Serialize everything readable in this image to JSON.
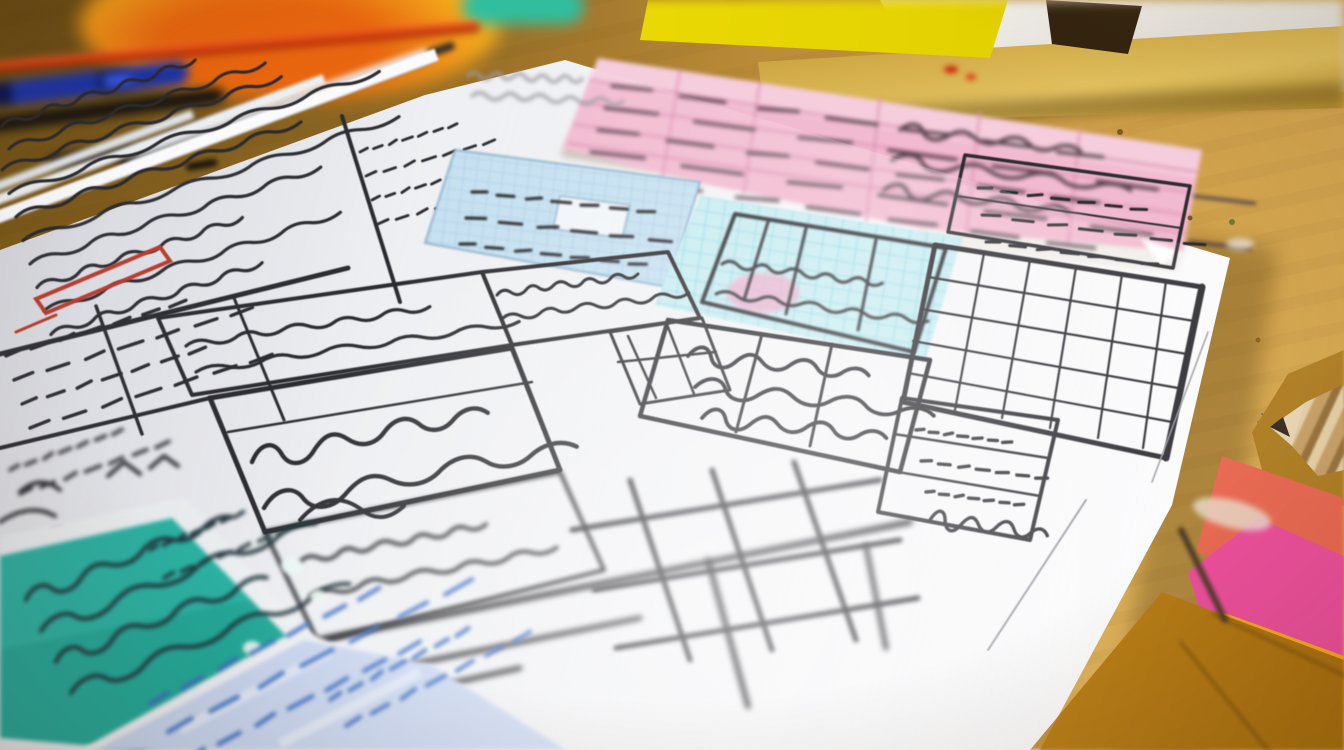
{
  "scene": {
    "title": "Hand-drawn wireframe sketches on a desk",
    "description": "Close-up photograph, shallow depth of field: a large white sheet covered with hand-drawn wireframe tables and grid panels lies on a warm golden wooden desk. Sections of the sketch are highlighted in pink, light blue, cyan, teal and lavender; one row is outlined in red ink. All handwriting is illegible scribble. Around the sheet: out-of-focus pens (red, blue, black, silver) at the top left, a bright yellow sticky note, a green marker cap, a wooden ruler or book edge and a white paper at the top right, a large pink ruled handwritten note across the top, and orange, magenta and salmon sticky notes with folded amber paper at the bottom right. A sharpened pencil and a small pencil leaf doodle appear at the right edge.",
    "handwriting_legible": false
  },
  "palette": {
    "desk": "#a87b2c",
    "desk_dark": "#8a651f",
    "desk_light": "#d9ab55",
    "paper": "#f5f5f7",
    "ink": "#2b2b30",
    "ink_soft": "#9a9aa2",
    "red_annotation": "#c23b2a",
    "pink_panel": "#f2bad0",
    "pink_note_row": "#dd93b4",
    "note_ink": "#52404a",
    "blue_panel": "#c6e1f1",
    "blue_grid": "#9cbedb",
    "cyan_panel": "#c8edf2",
    "cyan_grid": "#84d2e0",
    "pink_blob": "#f2a8c8",
    "teal_panel": "#29b2a2",
    "teal_ink": "#1c3238",
    "lavender_panel": "#c9d6f0",
    "lavender_ink": "#3a6cc0",
    "sticky_yellow": "#f6e607",
    "sticky_orange": "#f8a81e",
    "sticky_magenta": "#ec4f9b",
    "sticky_salmon": "#ef7f68",
    "paper_amber": "#cf9426",
    "pen_red": "#dd3a0e",
    "pen_blue": "#1c33a6",
    "pen_silver": "#d7d9dd",
    "pen_black": "#141210",
    "green_cap": "#2fbf9f",
    "ruler_wood": "#c9a03c",
    "pencil_wood": "#caa36a",
    "graphite": "#3a3226"
  },
  "objects": [
    {
      "name": "desk-surface",
      "description": "Warm golden-brown wooden desk surface"
    },
    {
      "name": "sketch-sheet",
      "description": "Large white sheet with hand-drawn wireframe tables, grids and illegible scribbled handwriting"
    },
    {
      "name": "sheet-stack-edges",
      "description": "Edges of extra white sheets stacked under the top sheet, upper left"
    },
    {
      "name": "background-paper",
      "description": "Out-of-focus white paper behind the wooden edge, top right"
    },
    {
      "name": "wooden-edge",
      "description": "Blurred wooden ruler / book edge across the top right"
    },
    {
      "name": "orange-object",
      "description": "Out-of-focus orange-yellow object, top left"
    },
    {
      "name": "red-pen",
      "description": "Red-orange pen lying diagonally, top left"
    },
    {
      "name": "blue-pen",
      "description": "Blue pen with clip, left edge"
    },
    {
      "name": "black-pen",
      "description": "Dark pen barrel under the blue pen"
    },
    {
      "name": "silver-pen",
      "description": "Silver pen with black grip, angled toward the paper"
    },
    {
      "name": "pen-clip",
      "description": "Small dark pen clip lying on the desk"
    },
    {
      "name": "yellow-sticky-note",
      "description": "Bright yellow sticky note, top center"
    },
    {
      "name": "green-marker-cap",
      "description": "Teal-green marker cap, top center-left"
    },
    {
      "name": "dark-object",
      "description": "Small dark blurred object on the wooden edge"
    },
    {
      "name": "pink-ruled-note",
      "description": "Large tilted pink ruled note with rows of illegible handwriting spanning the top of the scene"
    },
    {
      "name": "red-annotation",
      "description": "Red hand-drawn rectangle highlighting a row in the upper-left table"
    },
    {
      "name": "blue-grid-panel",
      "description": "Sketch section highlighted light blue with a fine grid"
    },
    {
      "name": "cyan-grid-panel",
      "description": "Sketch grid section highlighted cyan with a small pink highlight blob"
    },
    {
      "name": "right-grid-panel",
      "description": "Large ruled grid panel drawn on the right of the sketch"
    },
    {
      "name": "teal-note",
      "description": "Teal highlighted note with dark handwriting, bottom left"
    },
    {
      "name": "lavender-note",
      "description": "Pale lavender note with blue handwriting, bottom left"
    },
    {
      "name": "leaf-doodle",
      "description": "Small pencil leaf doodle near the right edge of the sheet"
    },
    {
      "name": "pencil",
      "description": "Sharpened wooden pencil entering from the right edge"
    },
    {
      "name": "salmon-note",
      "description": "Salmon colored note, bottom right"
    },
    {
      "name": "magenta-sticky",
      "description": "Bright magenta-pink sticky note, bottom right"
    },
    {
      "name": "orange-sticky",
      "description": "Bright orange sticky note, bottom right"
    },
    {
      "name": "amber-paper",
      "description": "Folded amber-orange paper at the bottom right corner"
    },
    {
      "name": "stick",
      "description": "Thin dark stick lying across the notes, bottom right"
    }
  ]
}
